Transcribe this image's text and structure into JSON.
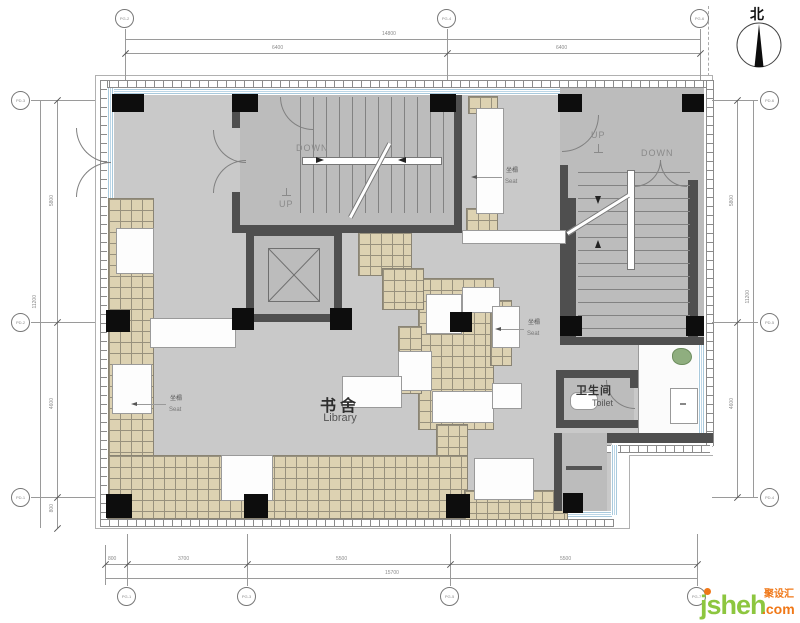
{
  "north": {
    "label": "北"
  },
  "labels": {
    "library_cn": "书舍",
    "library_en": "Library",
    "toilet_cn": "卫生间",
    "toilet_en": "Toilet",
    "seat_cn": "坐榻",
    "seat_en": "Seat",
    "up": "UP",
    "down": "DOWN"
  },
  "dimensions": {
    "top": {
      "overall": "14800",
      "seg1": "6400",
      "seg2": "6400"
    },
    "bottom": {
      "overall": "15700",
      "seg1": "800",
      "seg2": "3700",
      "seg3": "5500",
      "seg4": "5500"
    },
    "left": {
      "overall": "11200",
      "seg1": "5800",
      "seg2": "4600",
      "seg3": "800"
    },
    "right": {
      "overall": "11200",
      "seg1": "5800",
      "seg2": "4600"
    }
  },
  "grid_bubbles": {
    "top1": "PG-2",
    "top2": "PG-4",
    "top3": "PG-6",
    "bottom1": "PG-1",
    "bottom2": "PG-3",
    "bottom3": "PG-5",
    "bottom4": "PG-7",
    "left1": "PD-3",
    "left2": "PD-2",
    "left3": "PD-1",
    "right1": "PD-6",
    "right2": "PD-5",
    "right3": "PD-4"
  },
  "watermark": {
    "brand": "jsheh",
    "suffix": ".com",
    "cn": "聚设汇"
  },
  "colors": {
    "floor": "#c9c9c9",
    "stair_floor": "#bcbcbc",
    "wall": "#4f4f4f",
    "tile": "#ddd2b2",
    "glazing": "#aecde0",
    "watermark_green": "#8dc63f",
    "watermark_orange": "#f07818"
  }
}
